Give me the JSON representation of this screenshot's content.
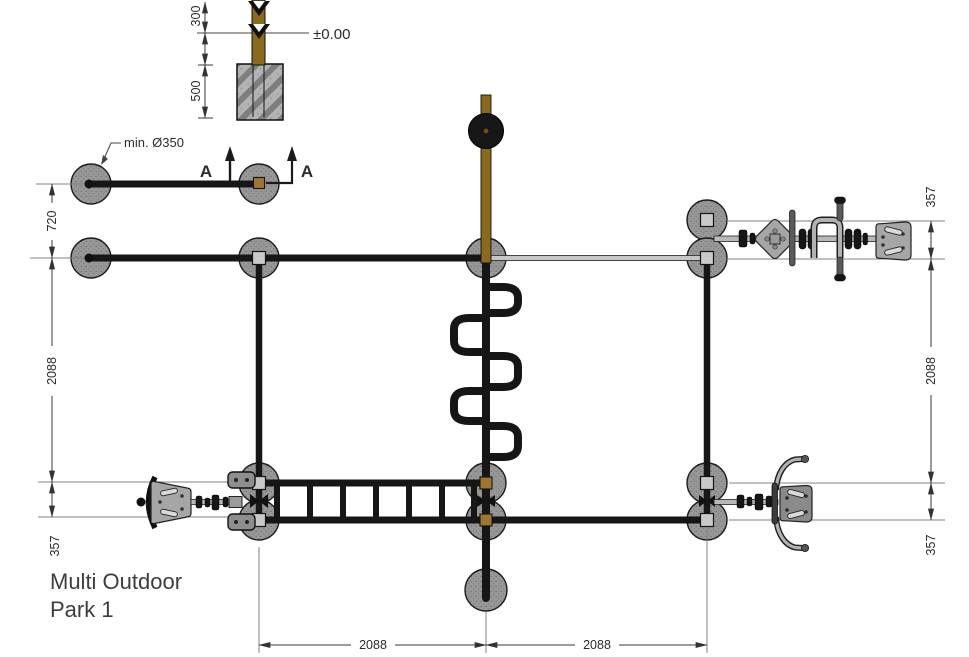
{
  "title": {
    "line1": "Multi Outdoor",
    "line2": "Park 1"
  },
  "section_detail": {
    "above_ground_height": "300",
    "foundation_depth": "500",
    "ground_level": "±0.00"
  },
  "annotations": {
    "min_foundation_diameter": "min. Ø350",
    "section_letter_left": "A",
    "section_letter_right": "A"
  },
  "dimensions": {
    "left_post_spacing": "720",
    "left_bay_depth": "2088",
    "left_ladder_width": "357",
    "right_machine_width": "357",
    "right_bay_depth": "2088",
    "right_ladder_width": "357",
    "bottom_bay_left": "2088",
    "bottom_bay_right": "2088"
  },
  "colors": {
    "wood_brown": "#8a6a1c",
    "foundation_gray": "#989898",
    "concrete_gray": "#b3b3b3",
    "beam_black": "#161616",
    "machine_gray": "#a6a6a6"
  }
}
